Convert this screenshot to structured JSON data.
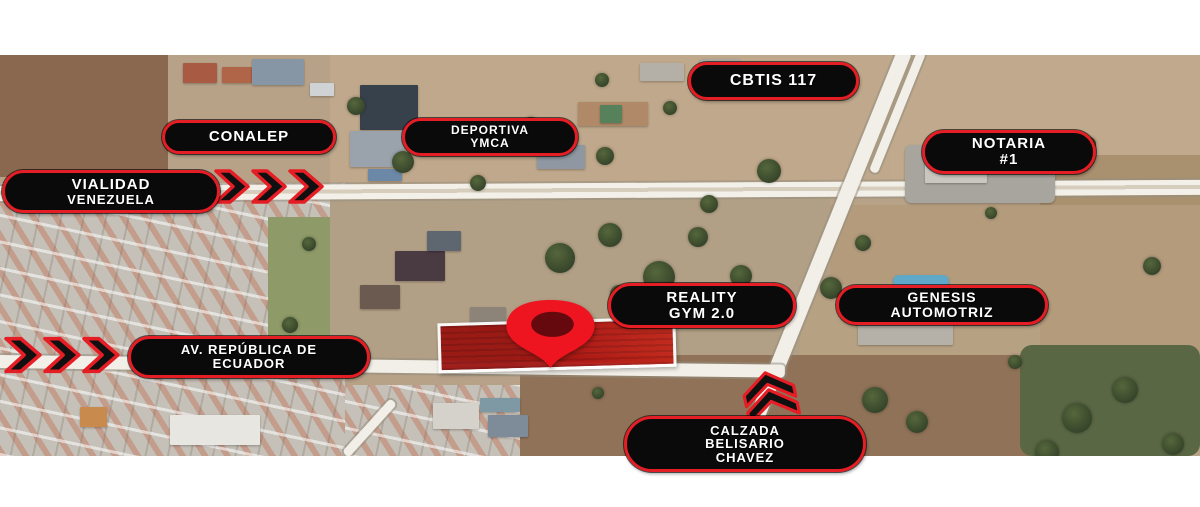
{
  "map_labels": {
    "cbtis": {
      "lines": [
        "CBTIS 117"
      ]
    },
    "conalep": {
      "lines": [
        "CONALEP"
      ]
    },
    "deportiva_ymca": {
      "lines": [
        "DEPORTIVA",
        "YMCA"
      ]
    },
    "notaria": {
      "lines": [
        "NOTARIA",
        "#1"
      ]
    },
    "vialidad_venezuela": {
      "lines": [
        "VIALIDAD",
        "VENEZUELA"
      ]
    },
    "reality_gym": {
      "lines": [
        "REALITY",
        "GYM 2.0"
      ]
    },
    "genesis_automotriz": {
      "lines": [
        "GENESIS",
        "AUTOMOTRIZ"
      ]
    },
    "av_republica_de_ecuador": {
      "lines": [
        "AV. REPÚBLICA DE",
        "ECUADOR"
      ]
    },
    "calzada_belisario_chavez": {
      "lines": [
        "CALZADA",
        "BELISARIO",
        "CHAVEZ"
      ]
    }
  },
  "icons": {
    "location_pin": "location-pin-icon",
    "chevrons_right_vialidad": "triple-chevron-right-icon",
    "chevrons_right_ecuador": "triple-chevron-right-icon",
    "chevrons_up_calzada": "double-chevron-up-icon"
  },
  "colors": {
    "pill_border": "#e51d24",
    "pill_bg": "#0a0a0a",
    "pill_text": "#ffffff",
    "pin_red": "#ee1520",
    "pin_core": "#65090e",
    "lot_fill": "#b01410",
    "lot_border": "#ffffff",
    "chevron_fill": "#101010",
    "chevron_stroke": "#e51d24",
    "road_white": "#f2efe8"
  }
}
